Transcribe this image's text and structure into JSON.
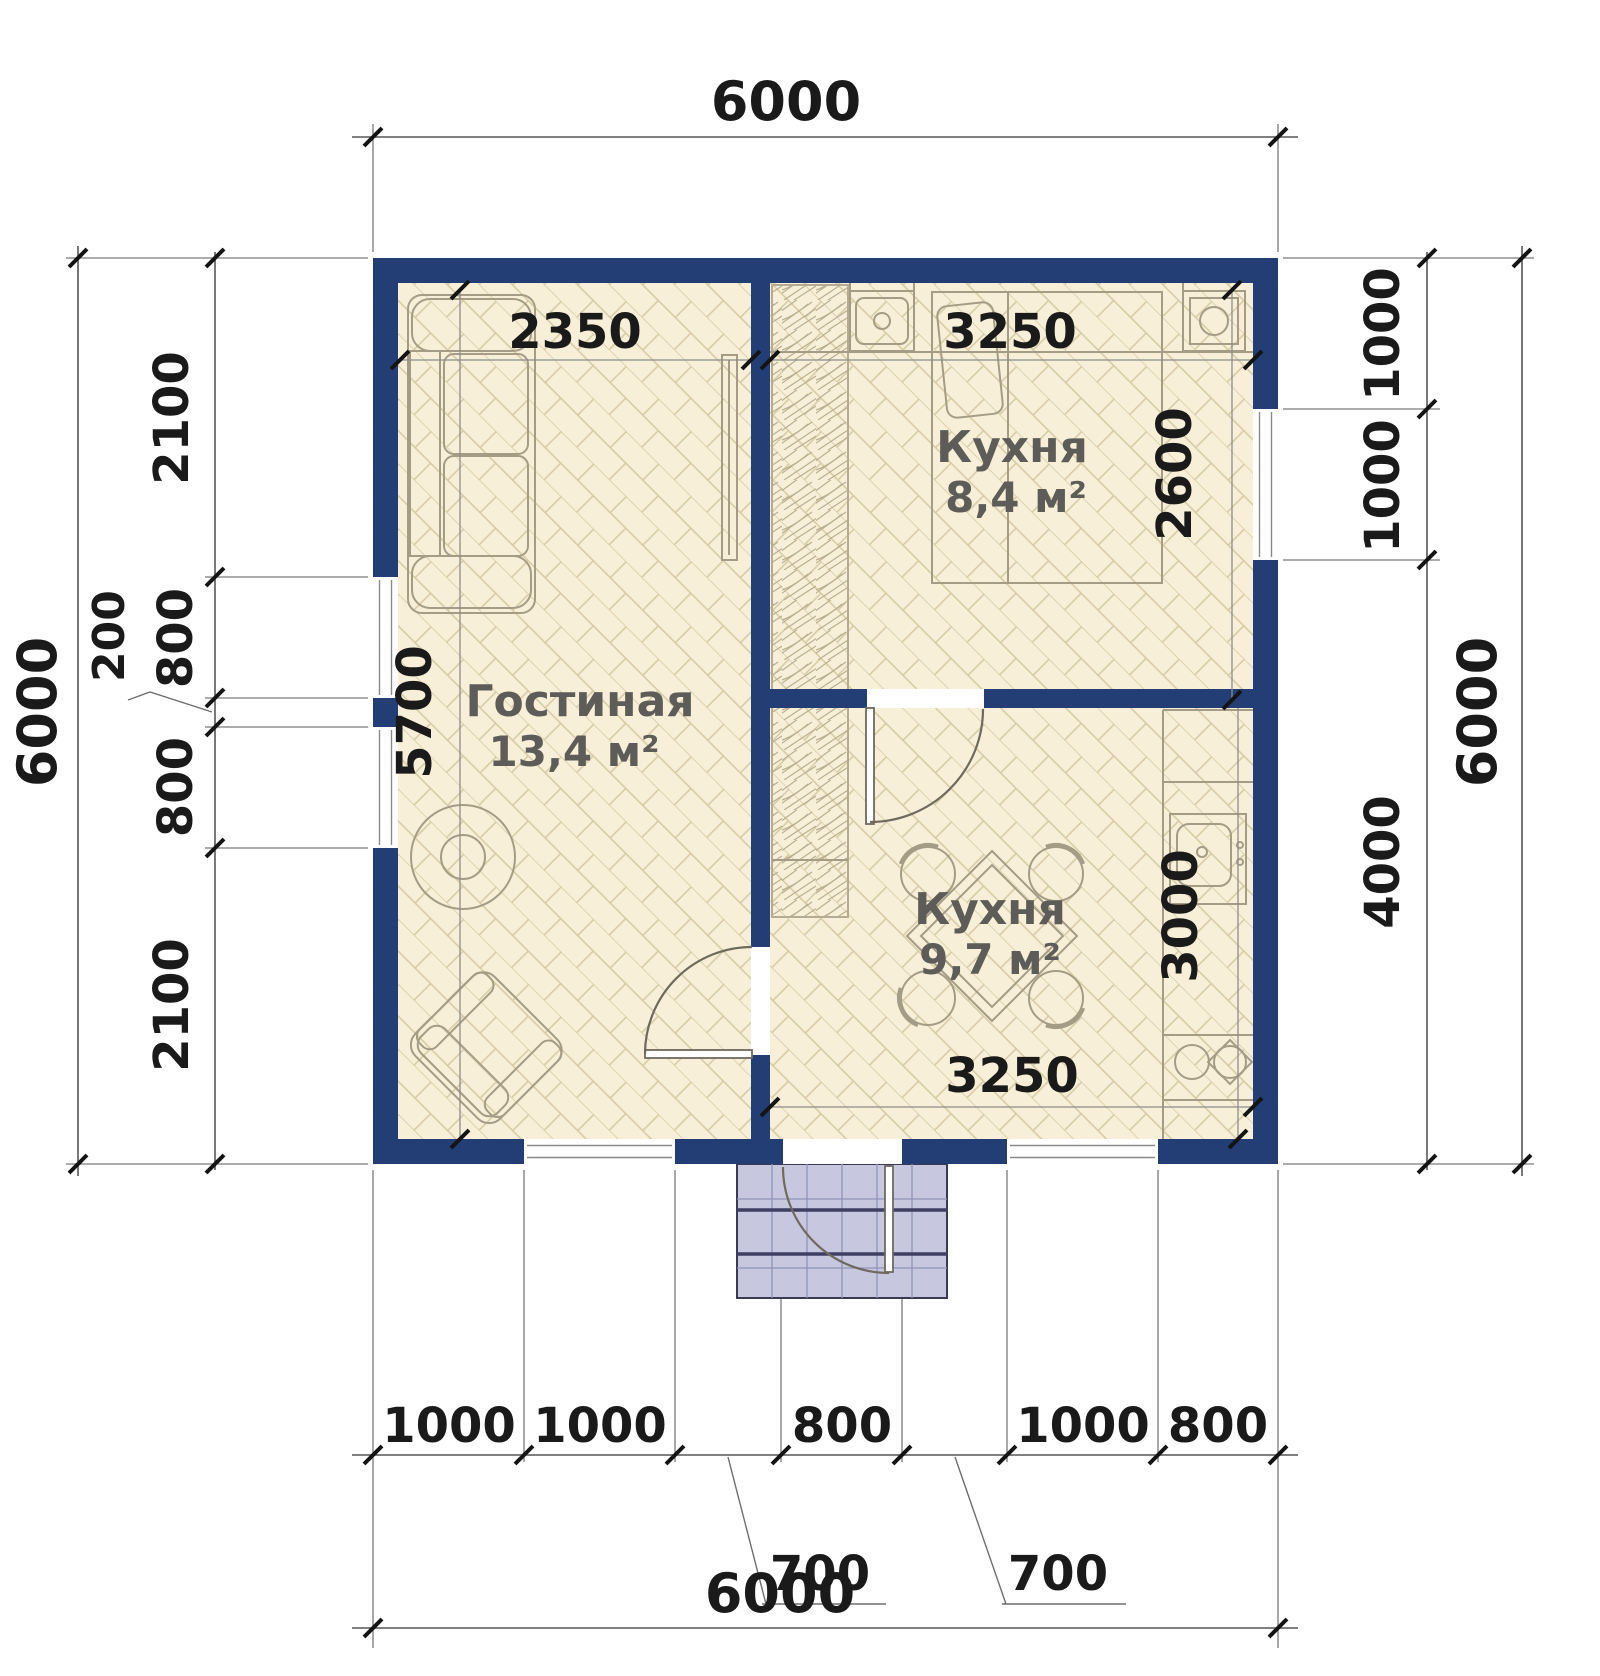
{
  "plan": {
    "dims": {
      "top_total": "6000",
      "bottom_total": "6000",
      "left_total": "6000",
      "right_total": "6000",
      "left_side": [
        "2100",
        "800",
        "200",
        "800",
        "2100"
      ],
      "right_side": [
        "1000",
        "1000",
        "4000"
      ],
      "bottom_row": [
        "1000",
        "1000",
        "800",
        "1000",
        "800"
      ],
      "bottom_offsets": [
        "700",
        "700"
      ],
      "living_width": "2350",
      "living_height": "5700",
      "kitchen_top_width": "3250",
      "kitchen_top_height": "2600",
      "kitchen_bottom_width": "3250",
      "kitchen_bottom_height": "3000"
    },
    "rooms": [
      {
        "name": "Гостиная",
        "area": "13,4 м²"
      },
      {
        "name": "Кухня",
        "area": "8,4 м²"
      },
      {
        "name": "Кухня",
        "area": "9,7 м²"
      }
    ],
    "colors": {
      "wall": "#223e74",
      "floor": "#f7efd7",
      "hatch": "#d5c9a4",
      "porch": "#c7c8e0",
      "porch_grid": "#9193b8",
      "furniture": "#a59c86",
      "dim_text": "#1a1a1a",
      "room_text": "#5d5c58"
    }
  }
}
